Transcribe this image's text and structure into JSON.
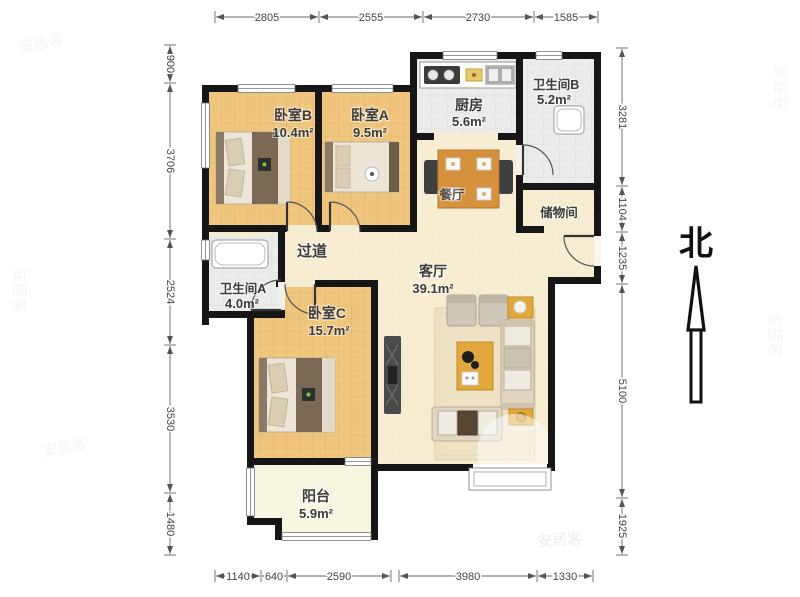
{
  "compass": {
    "label": "北"
  },
  "watermark": {
    "brand": "安居客"
  },
  "rooms": {
    "bedroom_b": {
      "name": "卧室B",
      "area": "10.4m²"
    },
    "bedroom_a": {
      "name": "卧室A",
      "area": "9.5m²"
    },
    "kitchen": {
      "name": "厨房",
      "area": "5.6m²"
    },
    "bathroom_b": {
      "name": "卫生间B",
      "area": "5.2m²"
    },
    "storage": {
      "name": "储物间"
    },
    "dining": {
      "name": "餐厅"
    },
    "hallway": {
      "name": "过道"
    },
    "living": {
      "name": "客厅",
      "area": "39.1m²"
    },
    "bathroom_a": {
      "name": "卫生间A",
      "area": "4.0m²"
    },
    "bedroom_c": {
      "name": "卧室C",
      "area": "15.7m²"
    },
    "balcony": {
      "name": "阳台",
      "area": "5.9m²"
    }
  },
  "dims": {
    "top": [
      "2805",
      "2555",
      "2730",
      "1585"
    ],
    "left": [
      "900",
      "3706",
      "2524",
      "3530",
      "1480"
    ],
    "right": [
      "3281",
      "1104",
      "1235",
      "5100",
      "1925"
    ],
    "bottom": [
      "1140",
      "640",
      "2590",
      "3980",
      "1330"
    ]
  },
  "colors": {
    "wall": "#161616",
    "wood_floor": "#F0C67E",
    "living_floor": "#F7EDD2",
    "tile_floor": "#EBEBE9",
    "balcony_floor": "#F8F5E1",
    "accent_furniture": "#E2A83C"
  }
}
